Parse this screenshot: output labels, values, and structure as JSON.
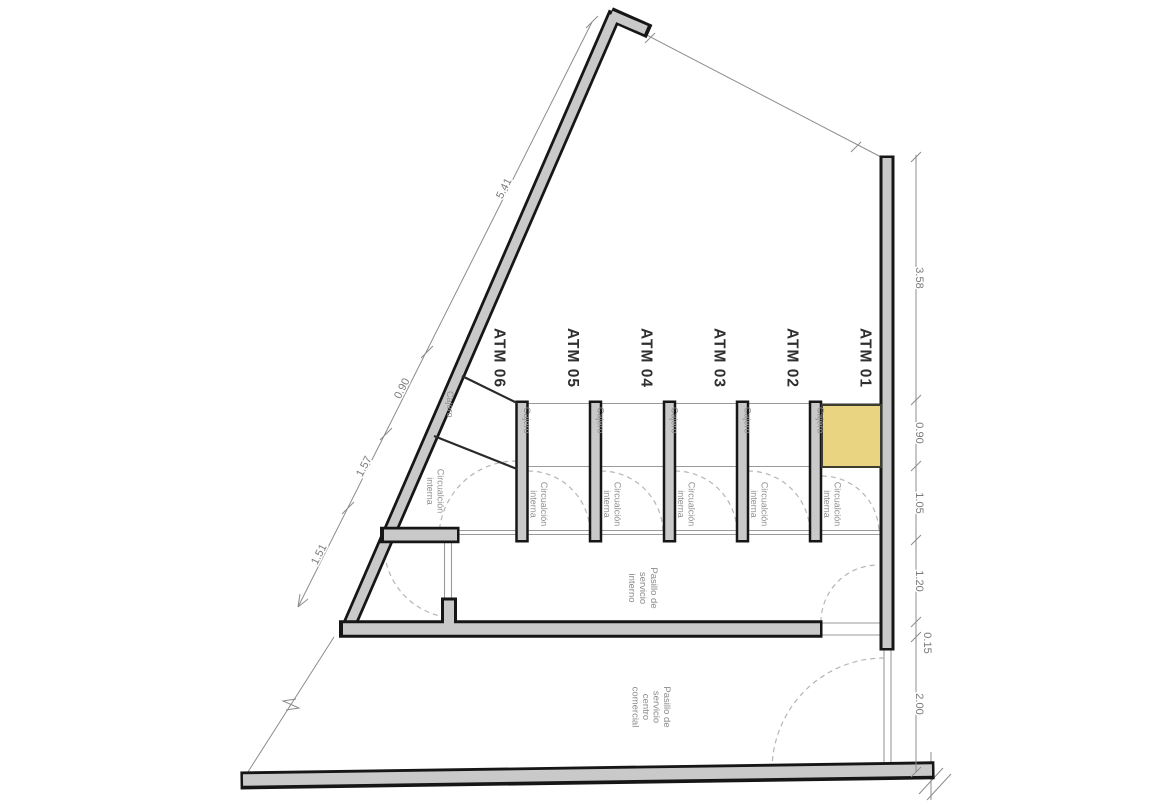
{
  "title": "ATM kiosks floor plan",
  "colors": {
    "highlight": "#e9d482",
    "highlight_border": "#3d3d2e",
    "wall_fill": "#c9c9c9",
    "wall_outline": "#161616",
    "thin_line": "#9a9a9a",
    "dashed_line": "#b6b6b6",
    "dimension": "#8c8c8c"
  },
  "highlighted_unit": "ATM 01",
  "atm_labels": [
    "ATM 06",
    "ATM 05",
    "ATM 04",
    "ATM 03",
    "ATM 02",
    "ATM 01"
  ],
  "stall": {
    "cajero": "Cajero",
    "circulation_line1": "Circualción",
    "circulation_line2": "interna"
  },
  "corridors": {
    "internal_line1": "Pasillo de",
    "internal_line2": "servicio",
    "internal_line3": "interno",
    "mall_line1": "Pasillo de",
    "mall_line2": "servicio",
    "mall_line3": "centro",
    "mall_line4": "comercial"
  },
  "dimensions": {
    "left": [
      "5.41",
      "0.90",
      "1.57",
      "1.51"
    ],
    "right": [
      "3.58",
      "0.90",
      "1.05",
      "1.20",
      "0.15",
      "2.00"
    ]
  }
}
